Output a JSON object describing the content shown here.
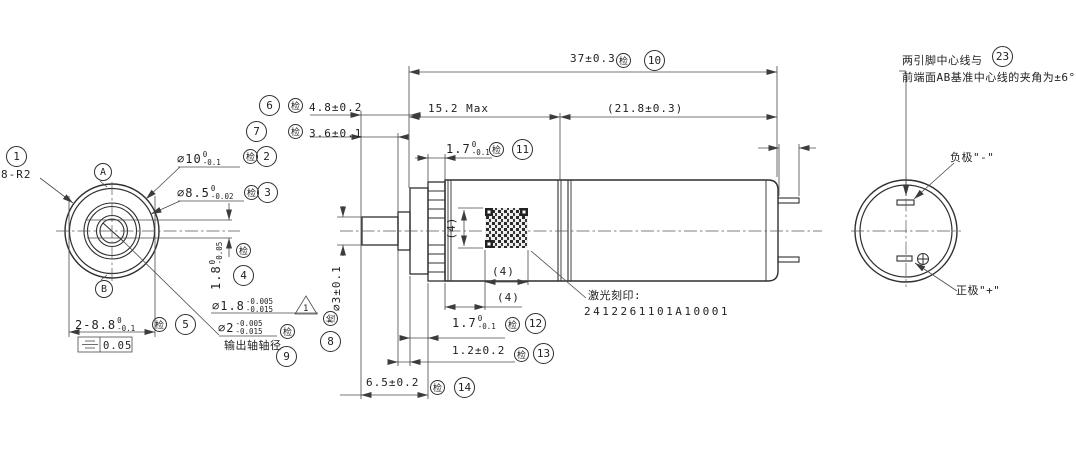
{
  "inspection_mark": "检",
  "balloons": {
    "n1": "1",
    "n2": "2",
    "n3": "3",
    "n4": "4",
    "n5": "5",
    "n6": "6",
    "n7": "7",
    "n8": "8",
    "n9": "9",
    "n10": "10",
    "n11": "11",
    "n12": "12",
    "n13": "13",
    "n14": "14",
    "n23": "23"
  },
  "front_view": {
    "corner_radius": "8-R2",
    "dia10": {
      "v": "⌀10",
      "up": "0",
      "lo": "-0.1"
    },
    "dia85": {
      "v": "⌀8.5",
      "up": "0",
      "lo": "-0.02"
    },
    "boss_height": {
      "v": "1.8",
      "up": "0",
      "lo": "-0.05"
    },
    "across_flats": {
      "v": "2-8.8",
      "up": "0",
      "lo": "-0.1"
    },
    "shaft_fit": {
      "v": "⌀1.8",
      "up": "-0.005",
      "lo": "-0.015",
      "flag": "1"
    },
    "shaft_dia": {
      "v": "⌀2",
      "up": "-0.005",
      "lo": "-0.015",
      "note": "输出轴轴径"
    },
    "symmetry_tol": "0.05",
    "datum_a": "A",
    "datum_b": "B"
  },
  "side_view": {
    "total_length": "37±0.3",
    "gear_section": "15.2 Max",
    "motor_section": "(21.8±0.3)",
    "front_boss": "4.8±0.2",
    "shaft_length": "3.6±0.1",
    "crown_width": {
      "v": "1.7",
      "up": "0",
      "lo": "-0.1"
    },
    "flange_width": {
      "v": "1.7",
      "up": "0",
      "lo": "-0.1"
    },
    "collar_width": "1.2±0.2",
    "front_length": "6.5±0.2",
    "shaft_od": "⌀3±0.1",
    "qr_height": "(4)",
    "qr_width": "(4)",
    "qr_offset": "(4)",
    "laser_label": "激光刻印:",
    "laser_code": "2412261101A10001"
  },
  "end_view": {
    "terminal_length": "(2)",
    "note_line1": "两引脚中心线与",
    "note_line2": "前端面AB基准中心线的夹角为±6°",
    "negative": "负极\"-\"",
    "positive": "正极\"+\""
  }
}
